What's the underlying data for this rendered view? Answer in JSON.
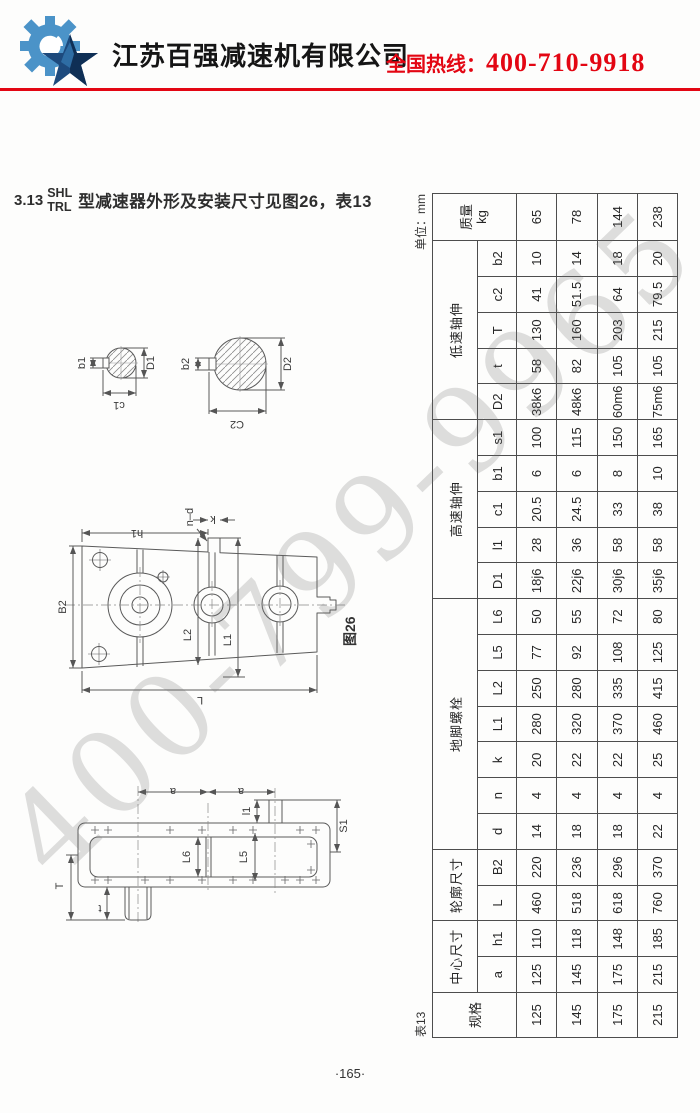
{
  "theme": {
    "accent_red": "#e30613",
    "logo_light_blue": "#4b93c8",
    "logo_dark_blue": "#1d4a7d",
    "watermark_gray": "#c9c9c9"
  },
  "header": {
    "company_name": "江苏百强减速机有限公司",
    "hotline_label": "全国热线：",
    "hotline_number": "400-710-9918"
  },
  "watermark": {
    "text": "400-799-9965"
  },
  "section": {
    "number": "3.13",
    "model_line1": "SHL",
    "model_line2": "TRL",
    "title": "型减速器外形及安装尺寸见图26，表13"
  },
  "figure": {
    "caption": "图26",
    "labels": {
      "b1": "b1",
      "D1": "D1",
      "c1": "c1",
      "b2": "b2",
      "D2": "D2",
      "C2": "C2",
      "B2": "B2",
      "h1": "h1",
      "nd": "n–d",
      "k": "k",
      "L2": "L2",
      "L1": "L1",
      "L": "L",
      "a": "a",
      "l1": "l1",
      "S1": "S1",
      "L6": "L6",
      "L5": "L5",
      "T": "T",
      "t": "t"
    }
  },
  "table": {
    "caption": "表13",
    "unit": "单位：mm",
    "spec_header": "规格",
    "mass_header": "质量",
    "mass_unit": "kg",
    "col_labels": {
      "a": "a",
      "h1": "h1",
      "L": "L",
      "B2": "B2",
      "d": "d",
      "n": "n",
      "k": "k",
      "L1": "L1",
      "L2": "L2",
      "L5": "L5",
      "L6": "L6",
      "D1": "D1",
      "l1": "l1",
      "c1": "c1",
      "b1": "b1",
      "s1": "s1",
      "D2": "D2",
      "t": "t",
      "T": "T",
      "c2": "c2",
      "b2": "b2"
    },
    "groups": [
      {
        "label": "中心尺寸",
        "cols": [
          "a",
          "h1"
        ]
      },
      {
        "label": "轮廓尺寸",
        "cols": [
          "L",
          "B2"
        ]
      },
      {
        "label": "地脚螺栓",
        "cols": [
          "d",
          "n",
          "k",
          "L1",
          "L2",
          "L5",
          "L6"
        ]
      },
      {
        "label": "高速轴伸",
        "cols": [
          "D1",
          "l1",
          "c1",
          "b1",
          "s1"
        ]
      },
      {
        "label": "低速轴伸",
        "cols": [
          "D2",
          "t",
          "T",
          "c2",
          "b2"
        ]
      }
    ],
    "rows": [
      {
        "spec": "125",
        "mass": "65",
        "dims": {
          "a": "125",
          "h1": "110",
          "L": "460",
          "B2": "220",
          "d": "14",
          "n": "4",
          "k": "20",
          "L1": "280",
          "L2": "250",
          "L5": "77",
          "L6": "50",
          "D1": "18j6",
          "l1": "28",
          "c1": "20.5",
          "b1": "6",
          "s1": "100",
          "D2": "38k6",
          "t": "58",
          "T": "130",
          "c2": "41",
          "b2": "10"
        }
      },
      {
        "spec": "145",
        "mass": "78",
        "dims": {
          "a": "145",
          "h1": "118",
          "L": "518",
          "B2": "236",
          "d": "18",
          "n": "4",
          "k": "22",
          "L1": "320",
          "L2": "280",
          "L5": "92",
          "L6": "55",
          "D1": "22j6",
          "l1": "36",
          "c1": "24.5",
          "b1": "6",
          "s1": "115",
          "D2": "48k6",
          "t": "82",
          "T": "160",
          "c2": "51.5",
          "b2": "14"
        }
      },
      {
        "spec": "175",
        "mass": "144",
        "dims": {
          "a": "175",
          "h1": "148",
          "L": "618",
          "B2": "296",
          "d": "18",
          "n": "4",
          "k": "22",
          "L1": "370",
          "L2": "335",
          "L5": "108",
          "L6": "72",
          "D1": "30j6",
          "l1": "58",
          "c1": "33",
          "b1": "8",
          "s1": "150",
          "D2": "60m6",
          "t": "105",
          "T": "203",
          "c2": "64",
          "b2": "18"
        }
      },
      {
        "spec": "215",
        "mass": "238",
        "dims": {
          "a": "215",
          "h1": "185",
          "L": "760",
          "B2": "370",
          "d": "22",
          "n": "4",
          "k": "25",
          "L1": "460",
          "L2": "415",
          "L5": "125",
          "L6": "80",
          "D1": "35j6",
          "l1": "58",
          "c1": "38",
          "b1": "10",
          "s1": "165",
          "D2": "75m6",
          "t": "105",
          "T": "215",
          "c2": "79.5",
          "b2": "20"
        }
      }
    ]
  },
  "footer": {
    "page_number": "·165·"
  }
}
